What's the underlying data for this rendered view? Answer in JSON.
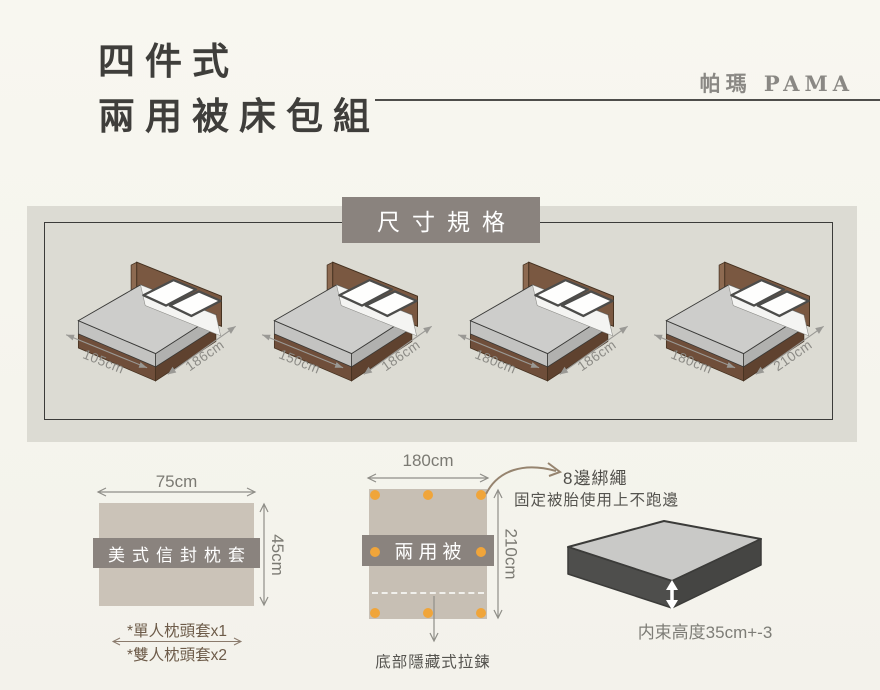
{
  "header": {
    "title_line1": "四件式",
    "title_line2": "兩用被床包組",
    "brand": "帕瑪 PAMA"
  },
  "spec_panel": {
    "title": "尺寸規格",
    "beds": [
      {
        "width": "105cm",
        "length": "186cm"
      },
      {
        "width": "150cm",
        "length": "186cm"
      },
      {
        "width": "180cm",
        "length": "186cm"
      },
      {
        "width": "180cm",
        "length": "210cm"
      }
    ]
  },
  "pillow_diagram": {
    "width": "75cm",
    "height": "45cm",
    "label": "美式信封枕套",
    "note_single": "*單人枕頭套x1",
    "note_double": "*雙人枕頭套x2"
  },
  "quilt_diagram": {
    "width": "180cm",
    "height": "210cm",
    "label": "兩用被",
    "ties_title": "8邊綁繩",
    "ties_desc": "固定被胎使用上不跑邊",
    "zipper_note": "底部隱藏式拉鍊"
  },
  "mattress_diagram": {
    "height_note": "内束高度35cm+-3"
  },
  "colors": {
    "band_gray": "#8a837e",
    "dot_orange": "#f0a53a",
    "bed_frame_brown": "#7a5841",
    "fabric_taupe": "#cbc3b8",
    "panel_gray": "#dcdbd3"
  }
}
